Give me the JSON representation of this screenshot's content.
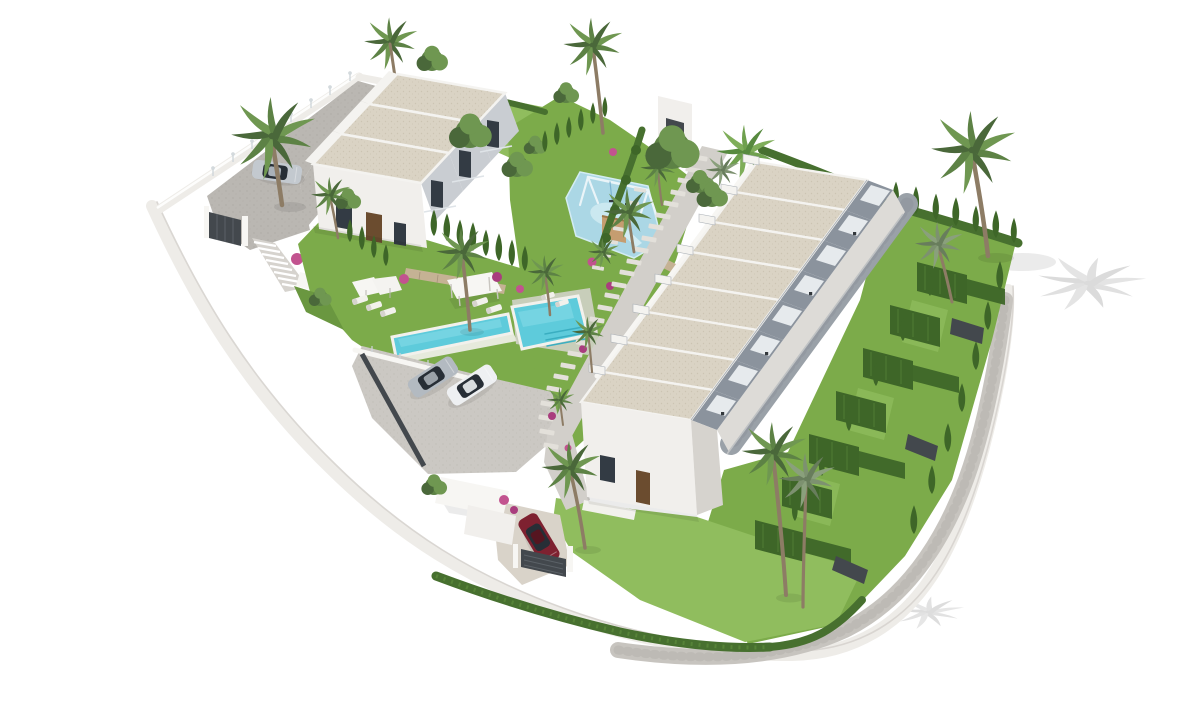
{
  "scene": {
    "type": "3d-architectural-site-render",
    "background": "#ffffff",
    "counts": {
      "townhouse_units": 8,
      "villa_roof_sections": 3,
      "cars_total": 4,
      "swimming_pools": 1,
      "kids_playgrounds": 1,
      "sun_loungers": 7
    }
  },
  "colors": {
    "bg": "#ffffff",
    "curb": "#eeece8",
    "curbLine": "#d6d3ce",
    "pathGray": "#c7c4bf",
    "pathDark": "#b2afa9",
    "driveway": "#bab7b2",
    "drivewayDot": "#a9a6a0",
    "parking": "#cbc8c3",
    "parkingDot": "#bbb8b2",
    "wallBright": "#f7f6f3",
    "wallWhite": "#f1efec",
    "wallShade": "#dddbd7",
    "wallGray": "#c9cdd2",
    "roof": "#dad3c4",
    "roofDot": "#c8c0ae",
    "parapet": "#f4f3f0",
    "roofEdge": "#aab0b6",
    "terrace": "#8b939d",
    "terraceDark": "#6e767f",
    "awning": "#e6eaed",
    "terracePath": "#9aa1a8",
    "terracePathDark": "#8b929a",
    "glassDark": "#333b44",
    "door": "#6b4c2f",
    "grass": "#7cab4a",
    "grassLight": "#90bd5e",
    "grassDark": "#6a9740",
    "grassPale": "#a5c973",
    "hedge": "#47702f",
    "cyp": "#3e6628",
    "cypLight": "#5d8c3c",
    "pool": "#5ecbdb",
    "poolLight": "#93e0ea",
    "poolDark": "#3aaec1",
    "coping": "#f2f1ec",
    "play": "#abd7e5",
    "playLight": "#d3ecf3",
    "playFrame": "#eaf4f8",
    "playBlue": "#7db4d2",
    "wood": "#c59d70",
    "trunk": "#8d7c65",
    "frond1": "#5d8245",
    "frond2": "#6f9751",
    "frond3": "#4a683a",
    "flower": "#c2538f",
    "flower2": "#a93d7e",
    "carSilver": "#b3bac1",
    "carWhite": "#eef0f2",
    "carGlass": "#272e36",
    "carRed": "#7e2130",
    "carRedDark": "#551520",
    "fence": "#43484d",
    "fenceDark": "#33383c",
    "stone": "#c5b294",
    "stoneDark": "#a6937a",
    "stoneStep": "#e3e0da",
    "shadow": "#d7d7d7"
  }
}
